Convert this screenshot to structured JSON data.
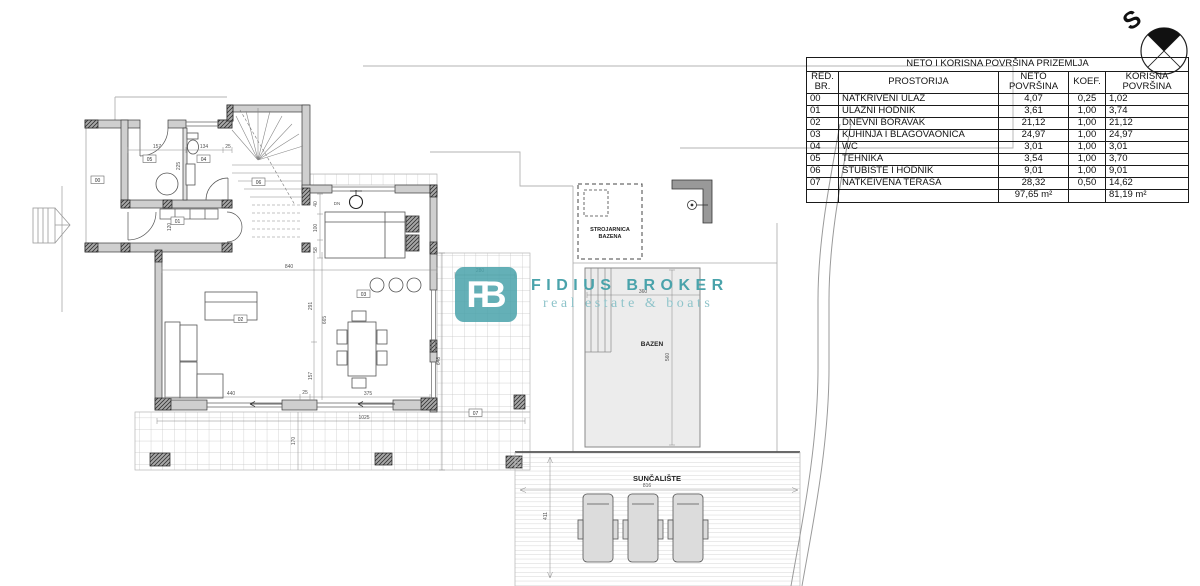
{
  "compass": {
    "letter": "S"
  },
  "logo": {
    "monogram": "FB",
    "name": "FIDIUS BROKER",
    "tagline": "real estate & boats",
    "teal": "#4aa3ab",
    "teal_light": "#8fc4ca"
  },
  "table": {
    "title": "NETO I KORISNA POVRŠINA PRIZEMLJA",
    "headers": {
      "red_br": "RED.\nBR.",
      "prostorija": "PROSTORIJA",
      "neto": "NETO\nPOVRŠINA",
      "koef": "KOEF.",
      "korisna": "KORISNA\nPOVRŠINA"
    },
    "rows": [
      {
        "id": "00",
        "name": "NATKRIVENI ULAZ",
        "neto": "4,07",
        "koef": "0,25",
        "korisna": "1,02"
      },
      {
        "id": "01",
        "name": "ULAZNI HODNIK",
        "neto": "3,61",
        "koef": "1,00",
        "korisna": "3,74"
      },
      {
        "id": "02",
        "name": "DNEVNI BORAVAK",
        "neto": "21,12",
        "koef": "1,00",
        "korisna": "21,12"
      },
      {
        "id": "03",
        "name": "KUHINJA I BLAGOVAONICA",
        "neto": "24,97",
        "koef": "1,00",
        "korisna": "24,97"
      },
      {
        "id": "04",
        "name": "WC",
        "neto": "3,01",
        "koef": "1,00",
        "korisna": "3,01"
      },
      {
        "id": "05",
        "name": "TEHNIKA",
        "neto": "3,54",
        "koef": "1,00",
        "korisna": "3,70"
      },
      {
        "id": "06",
        "name": "STUBIŠTE I HODNIK",
        "neto": "9,01",
        "koef": "1,00",
        "korisna": "9,01"
      },
      {
        "id": "07",
        "name": "NATKEIVENA TERASA",
        "neto": "28,32",
        "koef": "0,50",
        "korisna": "14,62"
      }
    ],
    "totals": {
      "neto": "97,65 m²",
      "korisna": "81,19 m²"
    }
  },
  "plan": {
    "labels": {
      "pool": "BAZEN",
      "pool_machine_line1": "STROJARNICA",
      "pool_machine_line2": "BAZENA",
      "sundeck": "SUNČALIŠTE",
      "down": "DN"
    },
    "rooms": {
      "r00": "00",
      "r01": "01",
      "r02": "02",
      "r03": "03",
      "r04": "04",
      "r05": "05",
      "r06": "06",
      "r07": "07"
    },
    "dims": {
      "d157a": "157",
      "d134": "134",
      "d25a": "25",
      "d225": "225",
      "d120": "120",
      "d840": "840",
      "d40": "40",
      "d100": "100",
      "d58": "58",
      "d291": "291",
      "d157b": "157",
      "d665": "665",
      "d440": "440",
      "d25b": "25",
      "d375": "375",
      "d1025": "1025",
      "d170": "170",
      "d280": "280",
      "d648": "648",
      "d360": "360",
      "d560": "560",
      "d816": "816",
      "d411": "411"
    }
  }
}
